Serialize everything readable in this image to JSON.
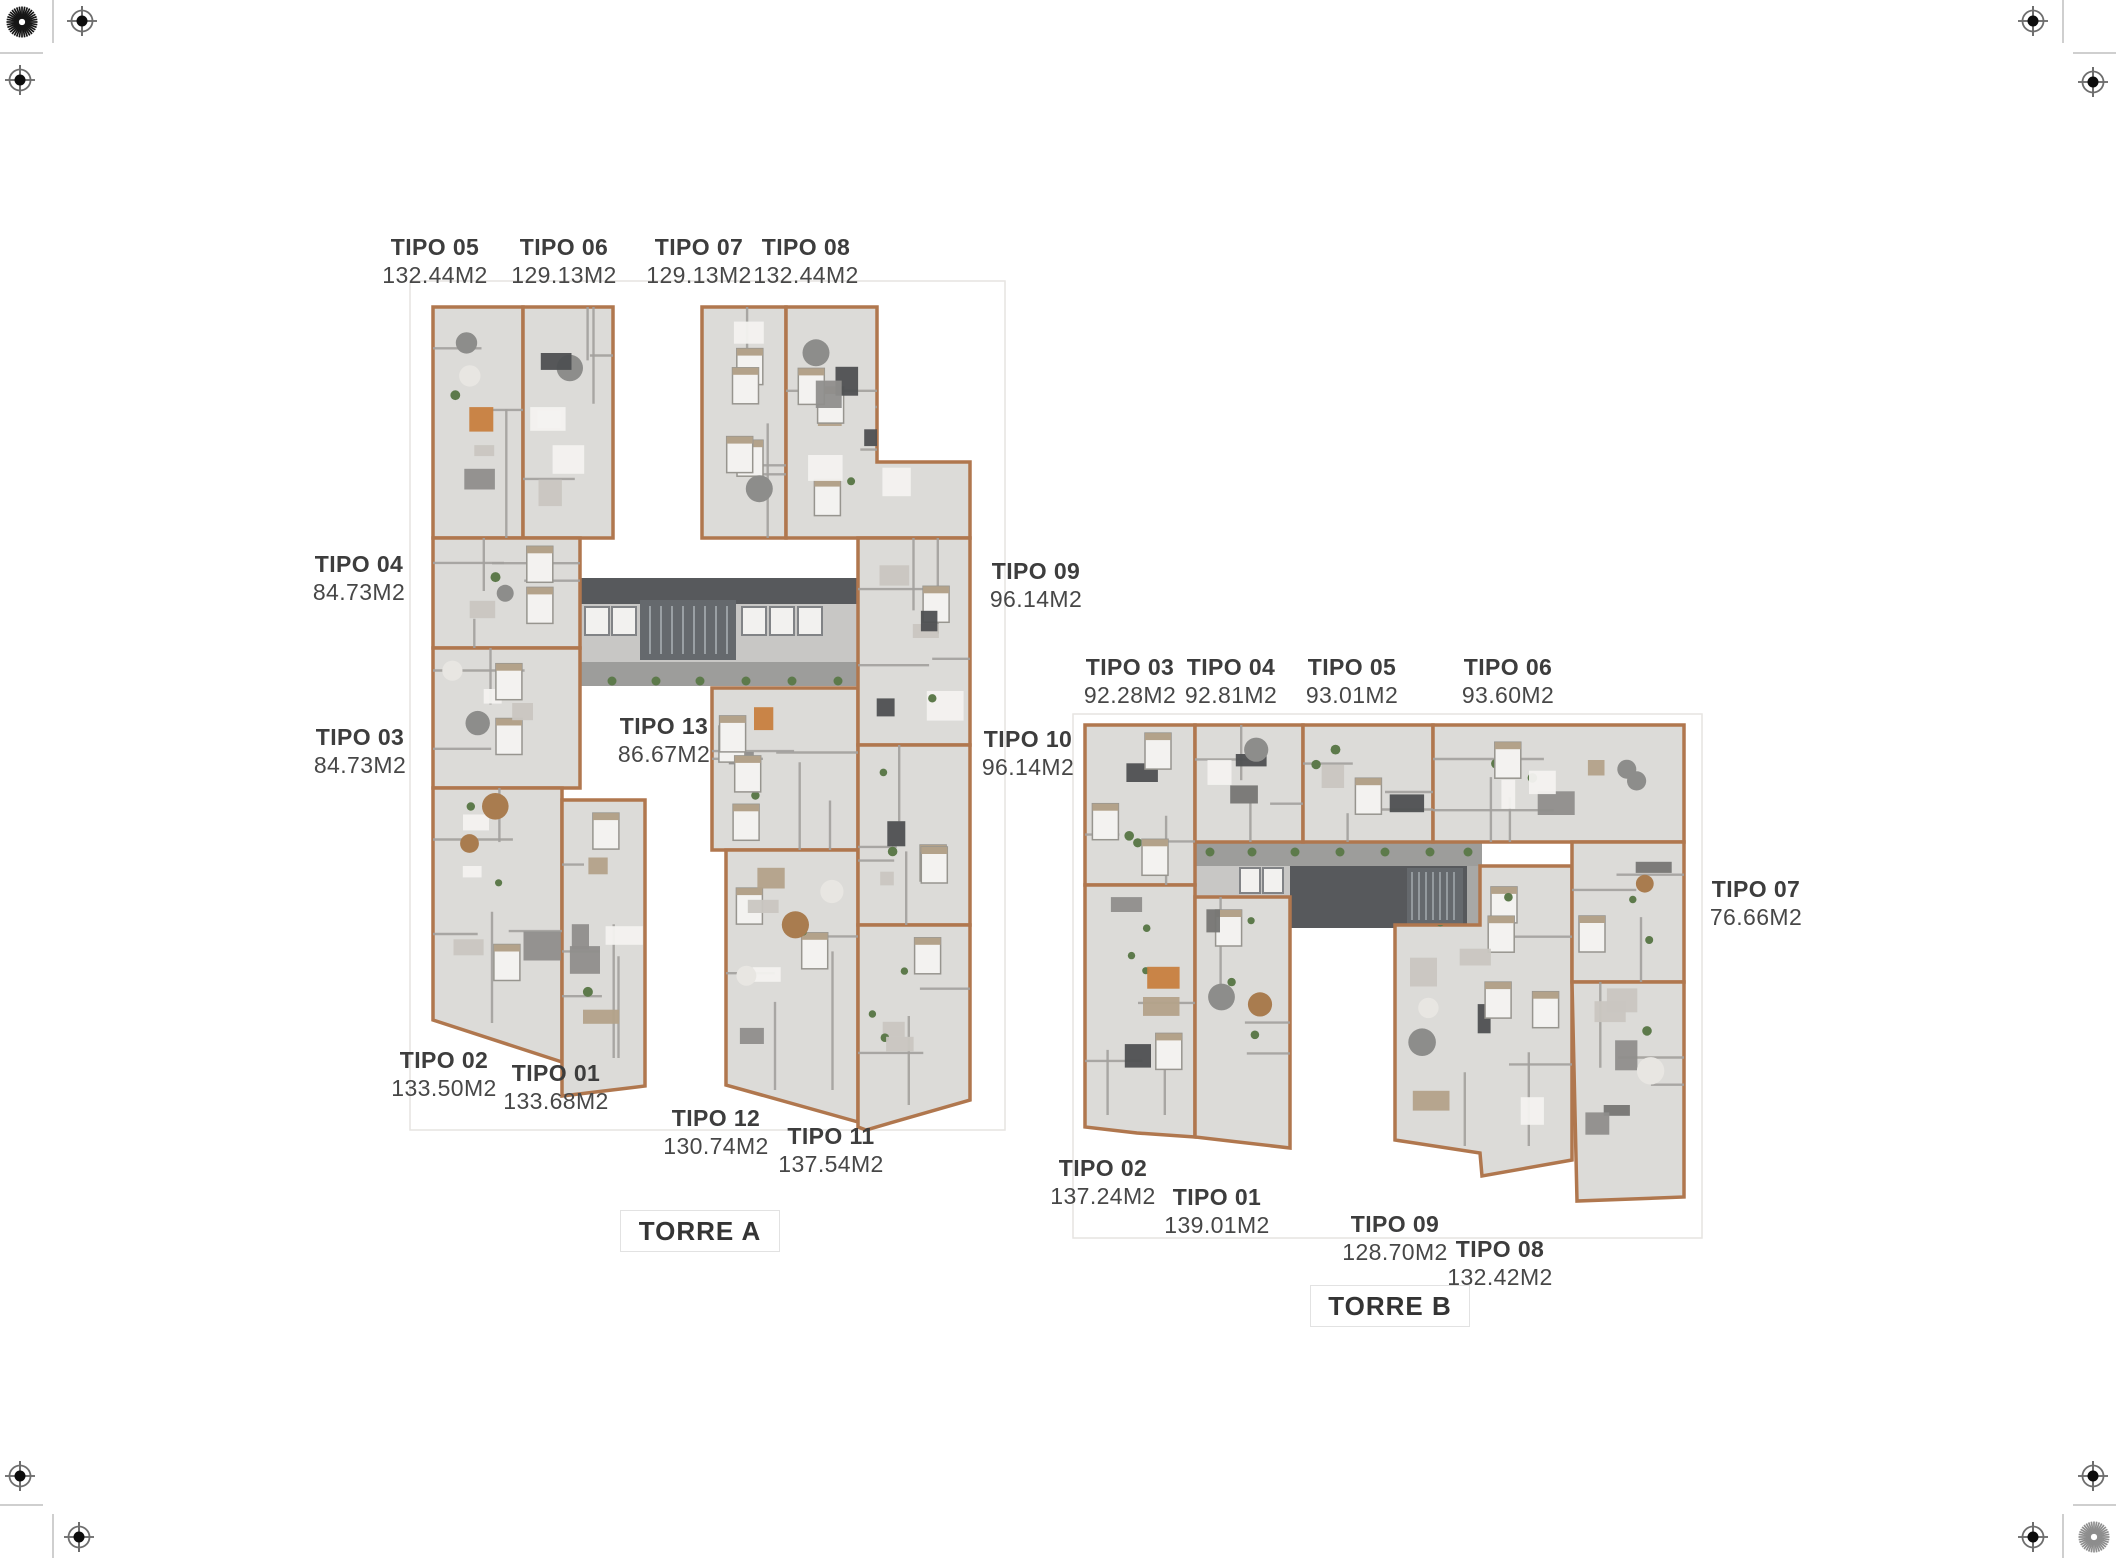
{
  "page": {
    "background": "#ffffff"
  },
  "palette": {
    "unit_outline": "#b0774e",
    "floor": "#dcdbd8",
    "floor_shade": "#cfcecb",
    "interior_wall": "#a3a19e",
    "corridor": "#a8a8a6",
    "walkway": "#9d9d9b",
    "lobby": "#c8c7c5",
    "core_dark": "#57595c",
    "stair": "#65696d",
    "stair_tread": "#9aa0a4",
    "elevator": "#f2f1ef",
    "elevator_edge": "#818386",
    "plant": "#5d7a4b",
    "label_text": "#3d3d3d",
    "artboard_line": "#e6e4e1",
    "mark_dark": "#161616",
    "mark_gray": "#8d8d8d",
    "corner_line": "#cfcfcf"
  },
  "torre_a": {
    "name": "TORRE A",
    "box": {
      "x": 620,
      "y": 1210,
      "w": 160,
      "h": 42
    },
    "labels": [
      {
        "tipo": "TIPO 05",
        "area": "132.44M2",
        "x": 435,
        "y": 247
      },
      {
        "tipo": "TIPO 06",
        "area": "129.13M2",
        "x": 564,
        "y": 247
      },
      {
        "tipo": "TIPO 07",
        "area": "129.13M2",
        "x": 699,
        "y": 247
      },
      {
        "tipo": "TIPO 08",
        "area": "132.44M2",
        "x": 806,
        "y": 247
      },
      {
        "tipo": "TIPO 04",
        "area": "84.73M2",
        "x": 359,
        "y": 564
      },
      {
        "tipo": "TIPO 03",
        "area": "84.73M2",
        "x": 360,
        "y": 737
      },
      {
        "tipo": "TIPO 09",
        "area": "96.14M2",
        "x": 1036,
        "y": 571
      },
      {
        "tipo": "TIPO 10",
        "area": "96.14M2",
        "x": 1028,
        "y": 739
      },
      {
        "tipo": "TIPO 13",
        "area": "86.67M2",
        "x": 664,
        "y": 726
      },
      {
        "tipo": "TIPO 02",
        "area": "133.50M2",
        "x": 444,
        "y": 1060
      },
      {
        "tipo": "TIPO 01",
        "area": "133.68M2",
        "x": 556,
        "y": 1073
      },
      {
        "tipo": "TIPO 12",
        "area": "130.74M2",
        "x": 716,
        "y": 1118
      },
      {
        "tipo": "TIPO 11",
        "area": "137.54M2",
        "x": 831,
        "y": 1136
      }
    ]
  },
  "torre_b": {
    "name": "TORRE B",
    "box": {
      "x": 1310,
      "y": 1285,
      "w": 160,
      "h": 42
    },
    "labels": [
      {
        "tipo": "TIPO 03",
        "area": "92.28M2",
        "x": 1130,
        "y": 667
      },
      {
        "tipo": "TIPO 04",
        "area": "92.81M2",
        "x": 1231,
        "y": 667
      },
      {
        "tipo": "TIPO 05",
        "area": "93.01M2",
        "x": 1352,
        "y": 667
      },
      {
        "tipo": "TIPO 06",
        "area": "93.60M2",
        "x": 1508,
        "y": 667
      },
      {
        "tipo": "TIPO 07",
        "area": "76.66M2",
        "x": 1756,
        "y": 889
      },
      {
        "tipo": "TIPO 02",
        "area": "137.24M2",
        "x": 1103,
        "y": 1168
      },
      {
        "tipo": "TIPO 01",
        "area": "139.01M2",
        "x": 1217,
        "y": 1197
      },
      {
        "tipo": "TIPO 09",
        "area": "128.70M2",
        "x": 1395,
        "y": 1224
      },
      {
        "tipo": "TIPO 08",
        "area": "132.42M2",
        "x": 1500,
        "y": 1249
      }
    ]
  },
  "icons": {
    "registration_crosshair": "crosshair-target",
    "registration_starburst": "starburst-target"
  }
}
